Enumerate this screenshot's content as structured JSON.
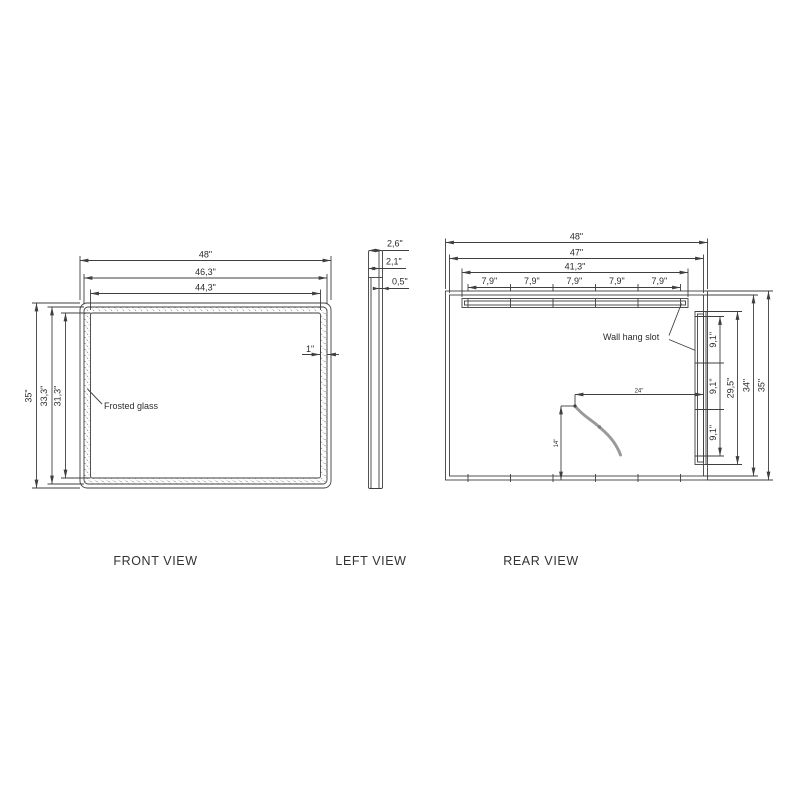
{
  "drawing": {
    "front_view": {
      "label": "FRONT VIEW",
      "width_dims": [
        "48\"",
        "46,3\"",
        "44,3\""
      ],
      "height_dims": [
        "35\"",
        "33,3\"",
        "31,3\""
      ],
      "frame_width_dim": "1\"",
      "material_note": "Frosted glass"
    },
    "left_view": {
      "label": "LEFT VIEW",
      "depth_dims": [
        "2,6\"",
        "2,1\"",
        "0,5\""
      ]
    },
    "rear_view": {
      "label": "REAR VIEW",
      "width_dims": [
        "48\"",
        "47\"",
        "41,3\""
      ],
      "slot_segment_dims": [
        "7,9\"",
        "7,9\"",
        "7,9\"",
        "7,9\"",
        "7,9\""
      ],
      "side_segment_dims": [
        "9,1\"",
        "9,1\"",
        "9,1\""
      ],
      "height_dims": [
        "29,5\"",
        "34\"",
        "35\""
      ],
      "slot_note": "Wall hang slot",
      "cord_horizontal_dim": "24\"",
      "cord_vertical_dim": "14\""
    },
    "colors": {
      "line": "#3f3f3f",
      "stipple": "#8f8f8f",
      "cord": "#9a9a9a",
      "background": "#ffffff"
    }
  }
}
